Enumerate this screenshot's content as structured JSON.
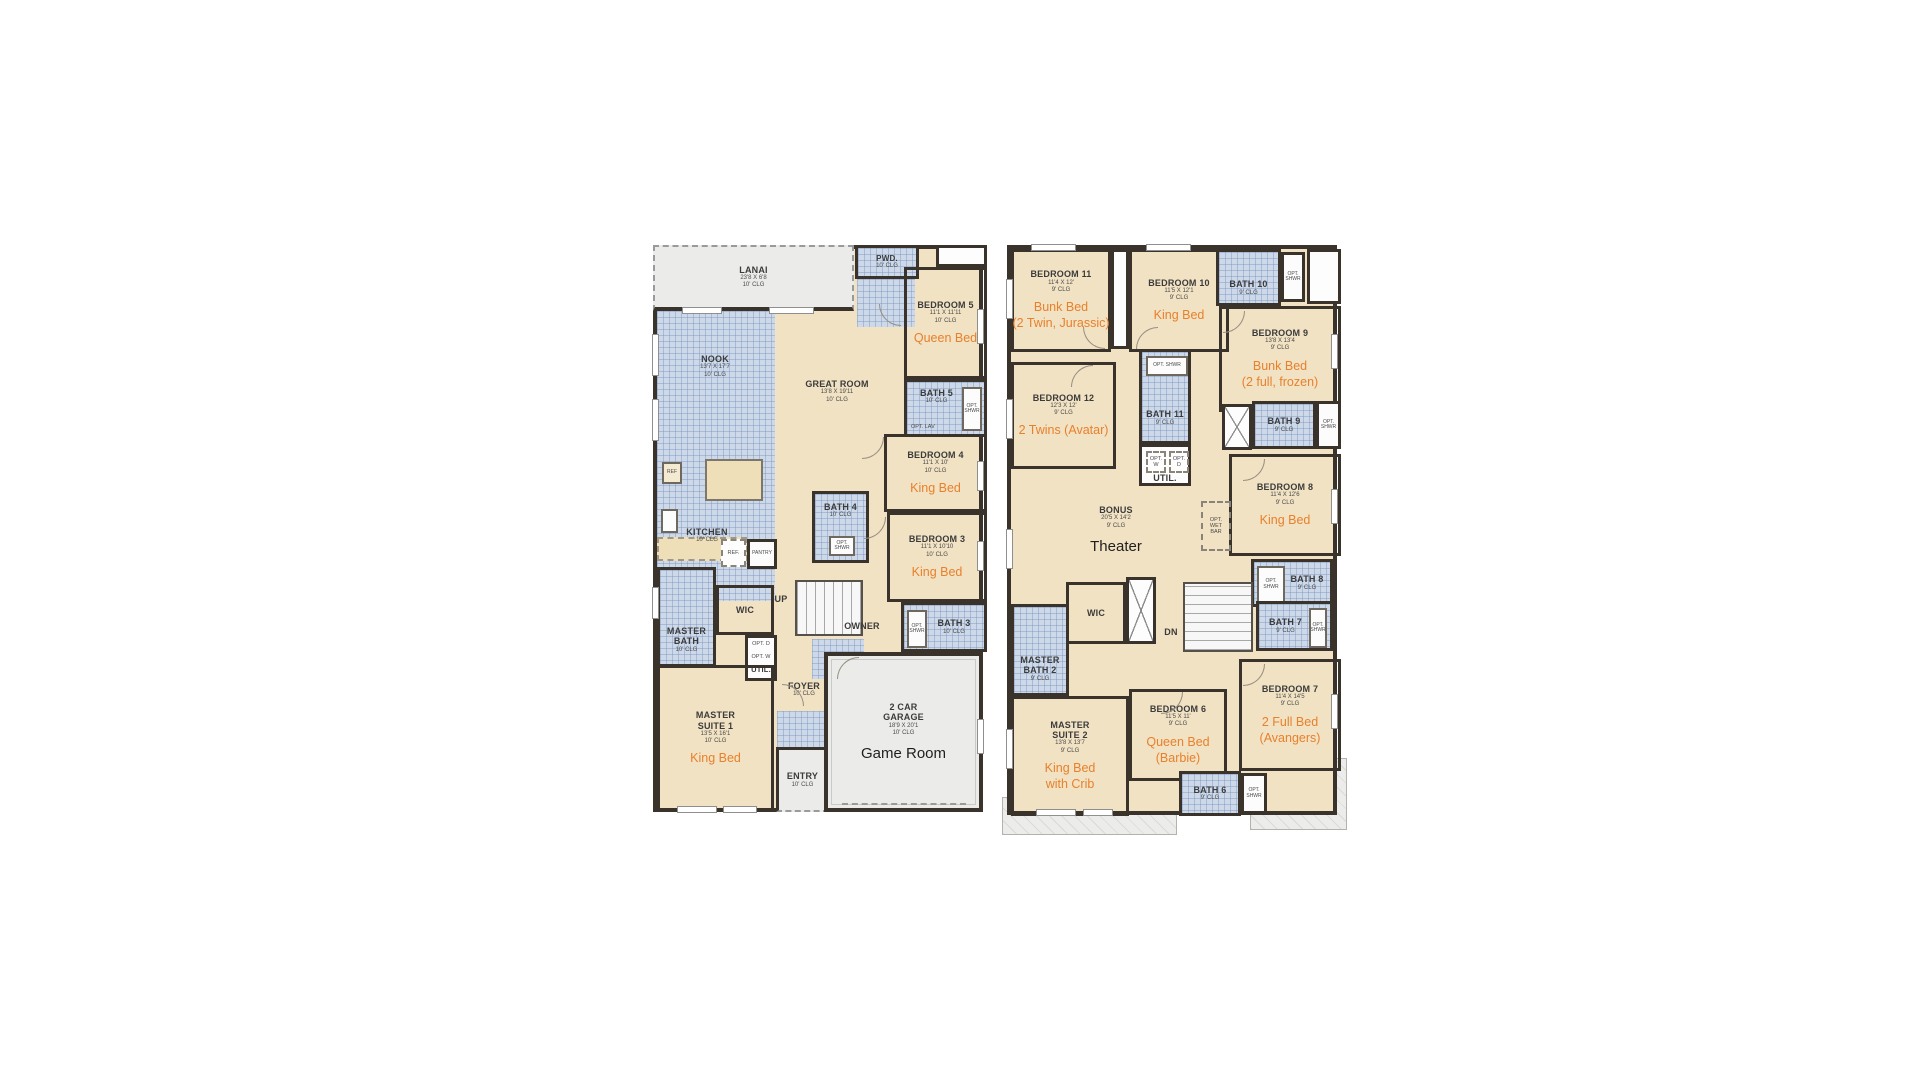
{
  "colors": {
    "wall_brown": "#3a332b",
    "room_tan": "#f1e2c3",
    "tile_blue": "#cdd9e9",
    "exterior_gray": "#ebebe9",
    "accent_orange": "#e8802c"
  },
  "plan1": {
    "rooms": {
      "lanai": {
        "name": "LANAI",
        "dims": "23'8 X 6'8",
        "clg": "10' CLG"
      },
      "pwd": {
        "name": "PWD.",
        "clg": "10' CLG"
      },
      "bedroom5": {
        "name": "BEDROOM 5",
        "dims": "11'1 X 11'11",
        "clg": "10' CLG",
        "note": "Queen Bed"
      },
      "bath5": {
        "name": "BATH 5",
        "clg": "10' CLG",
        "opt_lav": "OPT. LAV",
        "opt_shwr": "OPT. SHWR"
      },
      "nook": {
        "name": "NOOK",
        "dims": "13'7 X 17'7",
        "clg": "10' CLG"
      },
      "great_room": {
        "name": "GREAT ROOM",
        "dims": "13'8 X 19'11",
        "clg": "10' CLG"
      },
      "kitchen": {
        "name": "KITCHEN",
        "clg": "10' CLG",
        "ref": "REF",
        "ref2": "REF.",
        "pantry": "PANTRY"
      },
      "bedroom4": {
        "name": "BEDROOM 4",
        "dims": "11'1 X 10'",
        "clg": "10' CLG",
        "note": "King Bed"
      },
      "bath4": {
        "name": "BATH 4",
        "clg": "10' CLG",
        "opt_shwr": "OPT. SHWR"
      },
      "bedroom3": {
        "name": "BEDROOM 3",
        "dims": "11'1 X 10'10",
        "clg": "10' CLG",
        "note": "King Bed"
      },
      "bath3": {
        "name": "BATH 3",
        "clg": "10' CLG",
        "opt_shwr": "OPT. SHWR"
      },
      "master_bath": {
        "name": "MASTER BATH",
        "clg": "10' CLG"
      },
      "wic": {
        "name": "WIC"
      },
      "util": {
        "name": "UTIL.",
        "opt_d": "OPT. D",
        "opt_w": "OPT. W"
      },
      "stairs": {
        "label": "UP"
      },
      "owner": {
        "label": "OWNER"
      },
      "foyer": {
        "name": "FOYER",
        "clg": "10' CLG"
      },
      "master_suite1": {
        "name": "MASTER SUITE 1",
        "dims": "13'5 X 16'1",
        "clg": "10' CLG",
        "note": "King Bed"
      },
      "entry": {
        "name": "ENTRY",
        "clg": "10' CLG"
      },
      "garage": {
        "name": "2 CAR GARAGE",
        "dims": "18'9 X 20'1",
        "clg": "10' CLG",
        "note": "Game Room"
      }
    }
  },
  "plan2": {
    "rooms": {
      "bedroom11": {
        "name": "BEDROOM 11",
        "dims": "11'4 X 12'",
        "clg": "9' CLG",
        "note": "Bunk Bed",
        "note2": "(2 Twin, Jurassic)"
      },
      "bedroom10": {
        "name": "BEDROOM 10",
        "dims": "11'5 X 12'1",
        "clg": "9' CLG",
        "note": "King Bed"
      },
      "bath10": {
        "name": "BATH 10",
        "clg": "9' CLG",
        "opt_shwr": "OPT. SHWR"
      },
      "bedroom9": {
        "name": "BEDROOM 9",
        "dims": "13'8 X 13'4",
        "clg": "9' CLG",
        "note": "Bunk Bed",
        "note2": "(2 full, frozen)"
      },
      "bedroom12": {
        "name": "BEDROOM 12",
        "dims": "12'3 X 12'",
        "clg": "9' CLG",
        "note": "2 Twins (Avatar)"
      },
      "bath11": {
        "name": "BATH 11",
        "clg": "9' CLG",
        "opt_shwr": "OPT. SHWR"
      },
      "util": {
        "name": "UTIL.",
        "opt_w": "OPT. W",
        "opt_d": "OPT. D"
      },
      "bath9": {
        "name": "BATH 9",
        "clg": "9' CLG",
        "opt_shwr": "OPT. SHWR"
      },
      "bedroom8": {
        "name": "BEDROOM 8",
        "dims": "11'4 X 12'6",
        "clg": "9' CLG",
        "note": "King Bed"
      },
      "bonus": {
        "name": "BONUS",
        "dims": "20'5 X 14'2",
        "clg": "9' CLG",
        "note": "Theater"
      },
      "wet_bar": {
        "label": "OPT. WET BAR"
      },
      "bath8": {
        "name": "BATH 8",
        "clg": "9' CLG",
        "opt_shwr": "OPT. SHWR"
      },
      "wic": {
        "name": "WIC"
      },
      "stairs": {
        "label": "DN"
      },
      "master_bath2": {
        "name": "MASTER BATH 2",
        "clg": "9' CLG"
      },
      "bath7": {
        "name": "BATH 7",
        "clg": "9' CLG",
        "opt_shwr": "OPT. SHWR"
      },
      "master_suite2": {
        "name": "MASTER SUITE 2",
        "dims": "13'8 X 13'7",
        "clg": "9' CLG",
        "note": "King Bed",
        "note2": "with Crib"
      },
      "bedroom6": {
        "name": "BEDROOM 6",
        "dims": "11'5 X 11'",
        "clg": "9' CLG",
        "note": "Queen Bed",
        "note2": "(Barbie)"
      },
      "bedroom7": {
        "name": "BEDROOM 7",
        "dims": "11'4 X 14'5",
        "clg": "9' CLG",
        "note": "2 Full Bed",
        "note2": "(Avangers)"
      },
      "bath6": {
        "name": "BATH 6",
        "clg": "9' CLG",
        "opt_shwr": "OPT. SHWR"
      }
    }
  }
}
